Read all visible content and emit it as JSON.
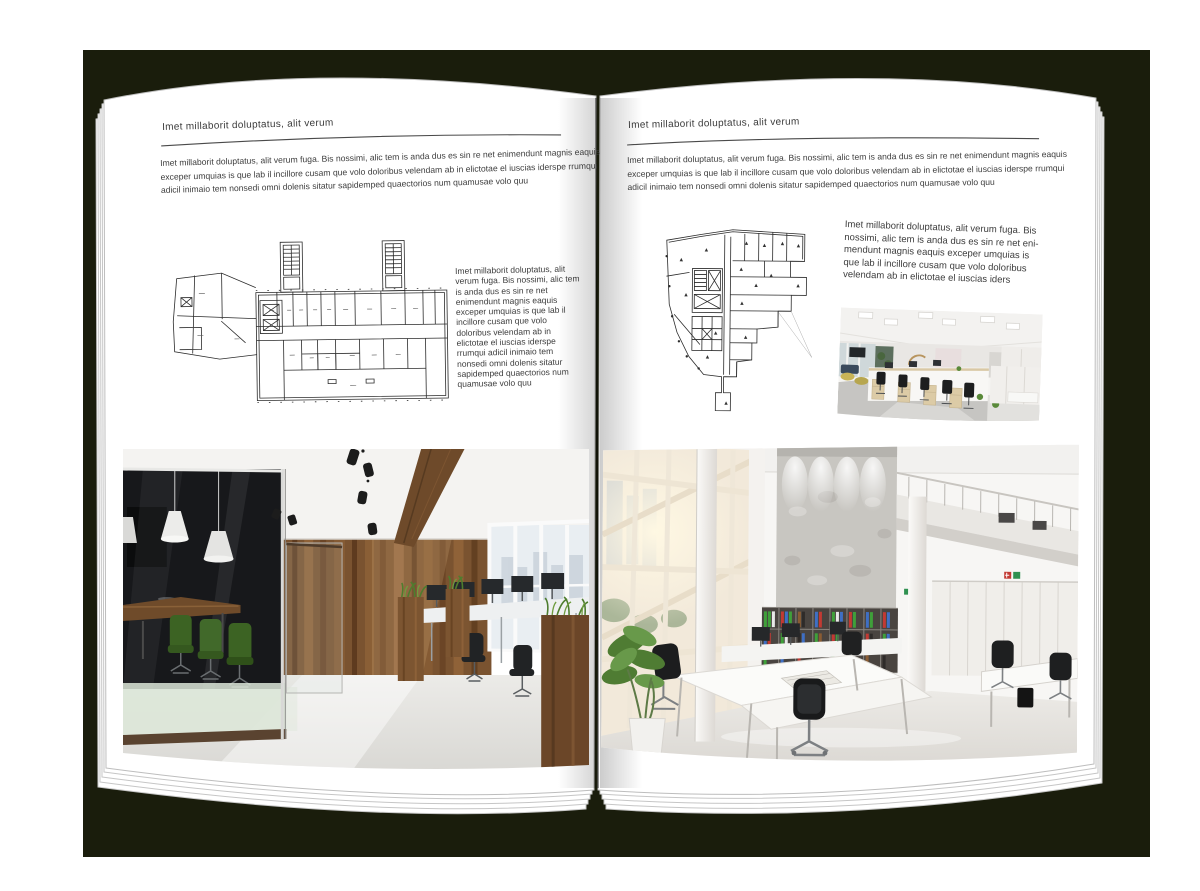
{
  "palette": {
    "backdrop": "#1a1d0c",
    "page": "#ffffff",
    "text": "#3d3d3d",
    "rule_line": "#4a4a4a",
    "plan_ink": "#2b2b2b",
    "wood_wall": "#7a5330",
    "plant_green": "#4e7d2e",
    "binder_green": "#3fa03a",
    "binder_blue": "#3f6fc4",
    "binder_red": "#c23a33"
  },
  "left_page": {
    "header": "Imet millaborit doluptatus, alit verum",
    "intro": "Imet millaborit doluptatus, alit verum fuga. Bis nossimi, alic tem is anda dus es sin re net enimendunt magnis eaquis exceper umquias is que lab il incillore cusam que volo doloribus velendam ab in elictotae el iuscias iderspe rrumqui adicil inimaio tem nonsedi omni dolenis sitatur sapidemped quaectorios num quamusae volo quu",
    "side_text": "Imet millaborit doluptatus, alit verum fuga. Bis nossimi, alic tem is anda dus es sin re net enimendunt magnis eaquis exceper umquias is que lab il incillore cusam que volo doloribus velendam ab in elictotae el iuscias iderspe rrumqui adicil inimaio tem nonsedi omni dolenis sitatur sapidemped quaectorios num quamusae volo quu",
    "floor_plan": "rectangular-building-floor-plan",
    "photo": "loft-office-interior-photo"
  },
  "right_page": {
    "header": "Imet millaborit doluptatus, alit verum",
    "intro": "Imet millaborit doluptatus, alit verum fuga. Bis nossimi, alic tem is anda dus es sin re net enimendunt magnis eaquis exceper umquias is que lab il incillore cusam que volo doloribus velendam ab in elictotae el iuscias iderspe rrumqui adicil inimaio tem nonsedi omni dolenis sitatur sapidemped quaectorios num quamusae volo quu",
    "side_text": "Imet millaborit doluptatus, alit verum fuga. Bis nossimi, alic tem is anda dus es sin re net eni-mendunt magnis eaquis exceper umquias is que lab il incillore cusam que volo doloribus velendam ab in elictotae el iuscias iders",
    "floor_plan": "irregular-building-floor-plan",
    "photo_small": "open-plan-cubicles-office-photo",
    "photo_large": "bright-atrium-office-photo"
  }
}
